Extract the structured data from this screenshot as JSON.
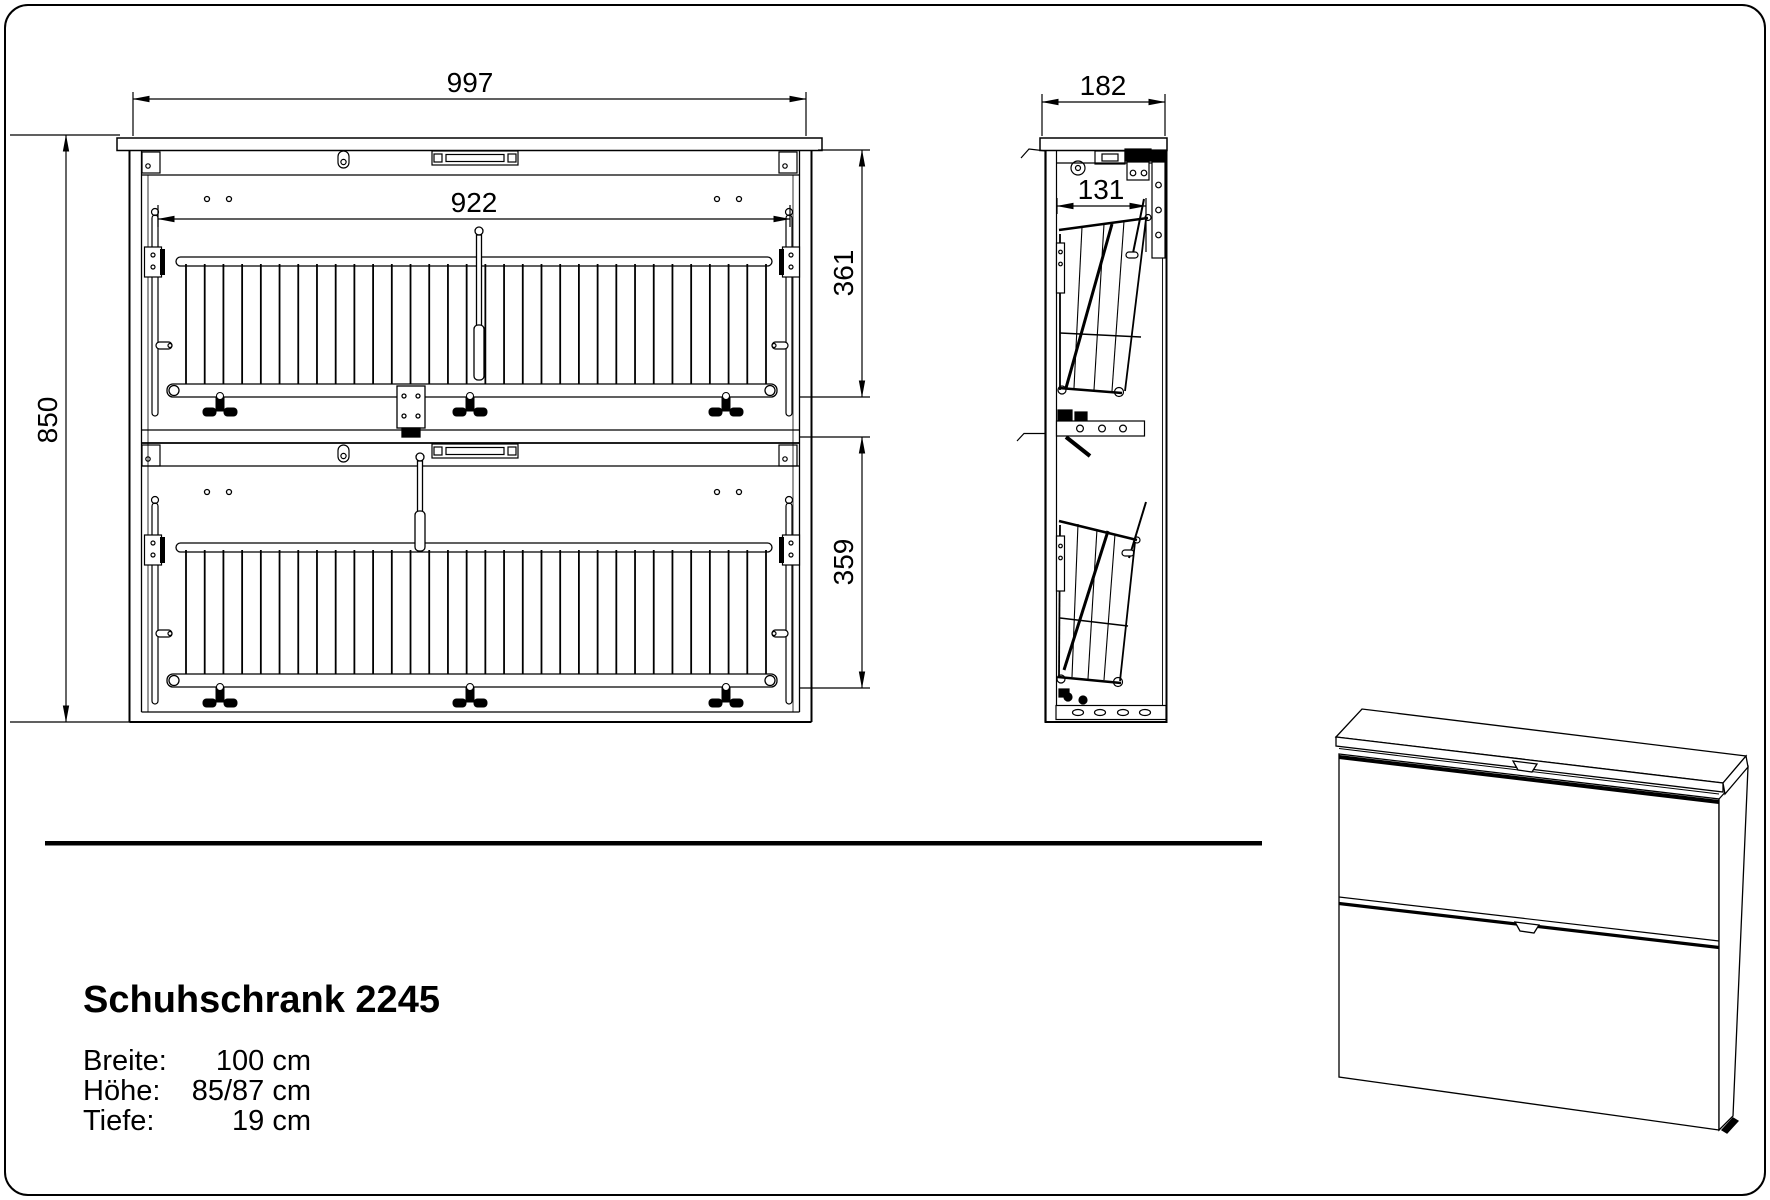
{
  "colors": {
    "line": "#000000",
    "background": "#ffffff"
  },
  "title": "Schuhschrank 2245",
  "specs": [
    {
      "label": "Breite:",
      "value": "100 cm"
    },
    {
      "label": "Höhe:",
      "value": "85/87 cm"
    },
    {
      "label": "Tiefe:",
      "value": "19 cm"
    }
  ],
  "dimensions": {
    "front_width_mm": "997",
    "front_height_mm": "850",
    "rack_width_mm": "922",
    "upper_section_mm": "361",
    "lower_section_mm": "359",
    "side_depth_mm": "182",
    "side_inner_depth_mm": "131"
  }
}
